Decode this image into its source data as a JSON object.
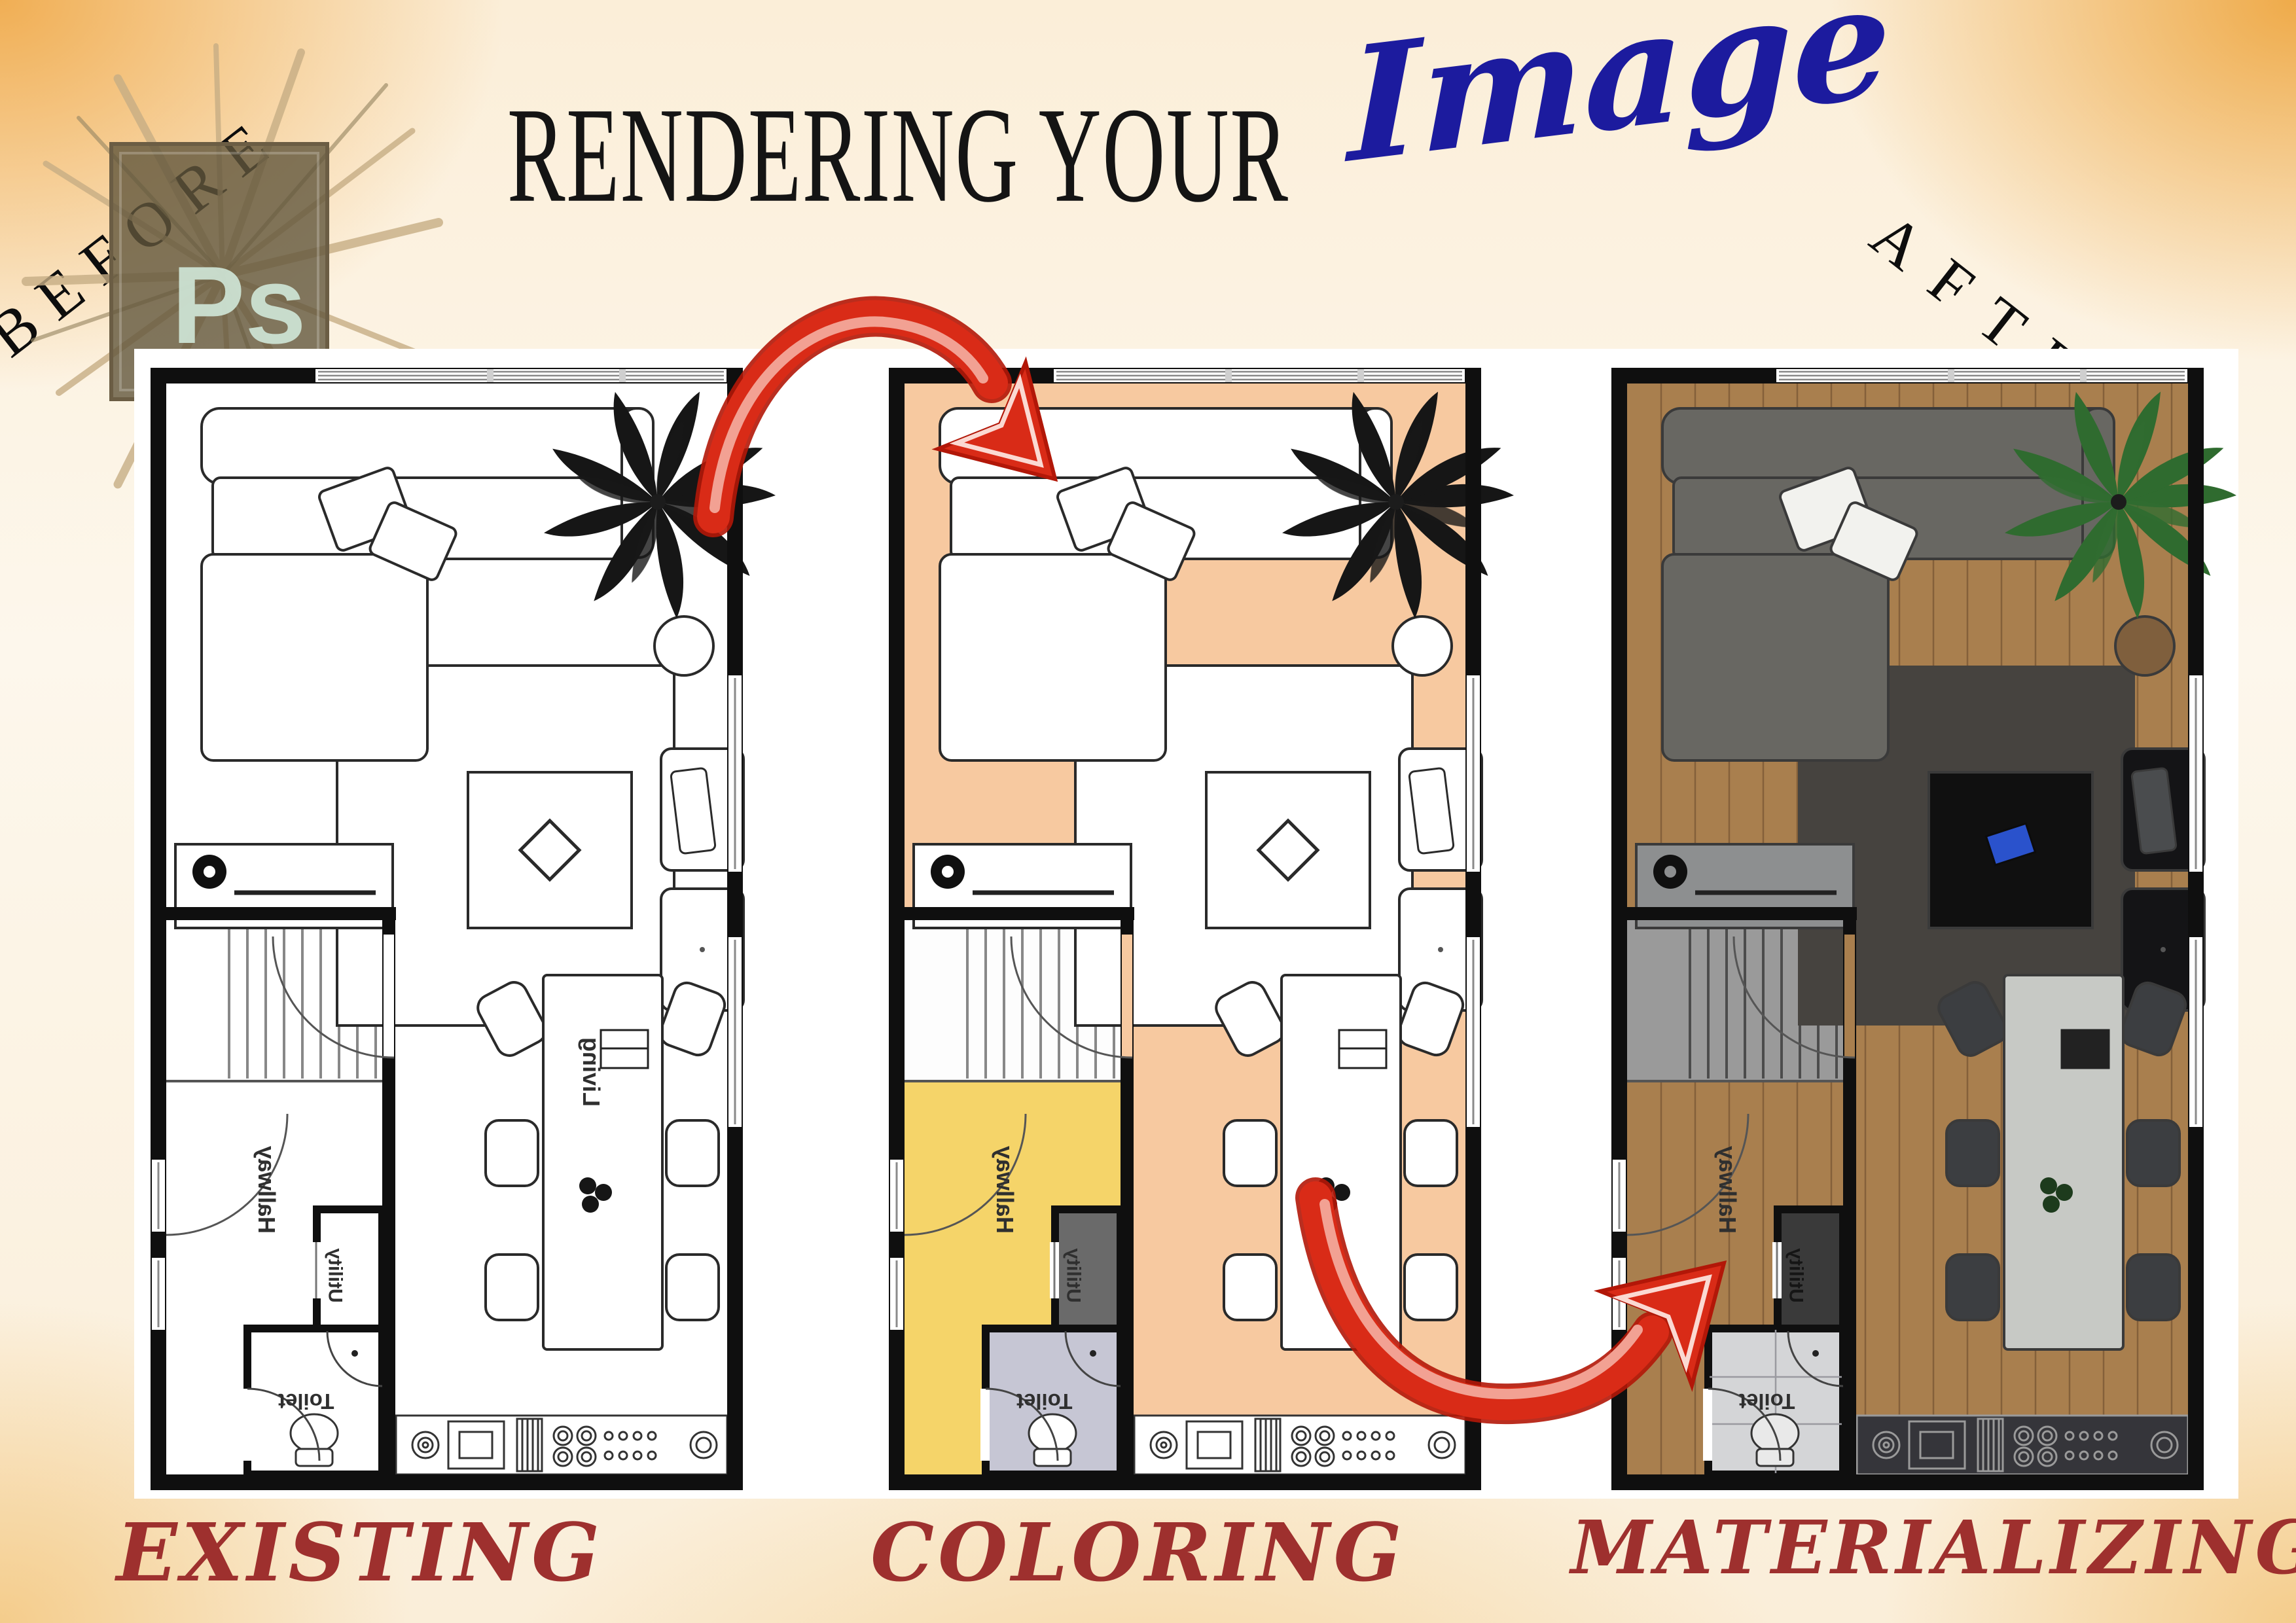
{
  "header": {
    "title_prefix": "RENDERING YOUR",
    "title_highlight": "Image",
    "before_label": "BEFORE",
    "after_label": "AFTER",
    "ps_logo_text": "Ps"
  },
  "plans": [
    {
      "caption": "EXISTING",
      "rooms": {
        "living": "Living",
        "hallway": "Hallway",
        "utility": "Utility",
        "toilet": "Toilet"
      }
    },
    {
      "caption": "COLORING",
      "rooms": {
        "hallway": "Hallway",
        "utility": "Utility",
        "toilet": "Toilet"
      }
    },
    {
      "caption": "MATERIALIZING",
      "rooms": {
        "hallway": "Hallway",
        "utility": "Utility",
        "toilet": "Toilet"
      }
    }
  ],
  "colors": {
    "title_text": "#141414",
    "title_highlight_blue": "#1c1b9e",
    "caption_red": "#9e302e",
    "arrow_red": "#d92b17",
    "coloring_floor_peach": "#f7c9a0",
    "coloring_hallway_yellow": "#f5d469",
    "coloring_utility_gray": "#6a6a6a",
    "coloring_toilet_lavender": "#c6c6d4",
    "materializing_wood_brown": "#a97f4e",
    "ps_logo_green": "#cfe5d6",
    "background_orange": "#f0ab4d"
  }
}
